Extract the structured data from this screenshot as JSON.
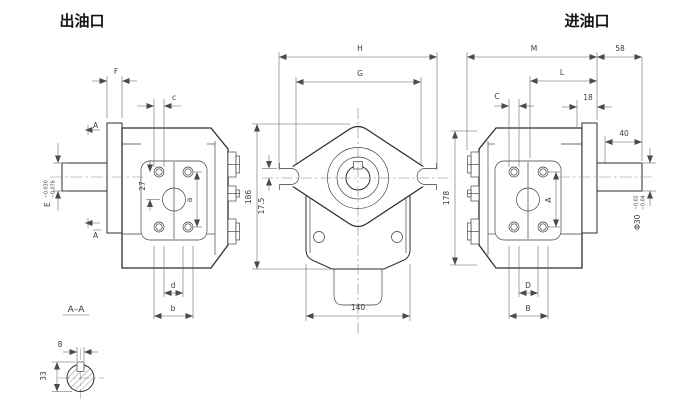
{
  "labels": {
    "outlet_port": "出油口",
    "inlet_port": "进油口",
    "section_title": "A–A",
    "section_marker": "A"
  },
  "dims": {
    "F": "F",
    "c": "c",
    "E": "E",
    "E_tol_up": "−0.030",
    "E_tol_low": "−0.076",
    "pitch27": "27",
    "a": "a",
    "d": "d",
    "b": "b",
    "H": "H",
    "G": "G",
    "height186": "186",
    "slot175": "17.5",
    "width140": "140",
    "M": "M",
    "ext58": "58",
    "L": "L",
    "off18": "18",
    "C": "C",
    "len40": "40",
    "A": "A",
    "D": "D",
    "B": "B",
    "height178": "178",
    "dia30": "Φ30",
    "dia_tol_up": "−0.02",
    "dia_tol_low": "−0.04",
    "key8": "8",
    "key33": "33"
  }
}
